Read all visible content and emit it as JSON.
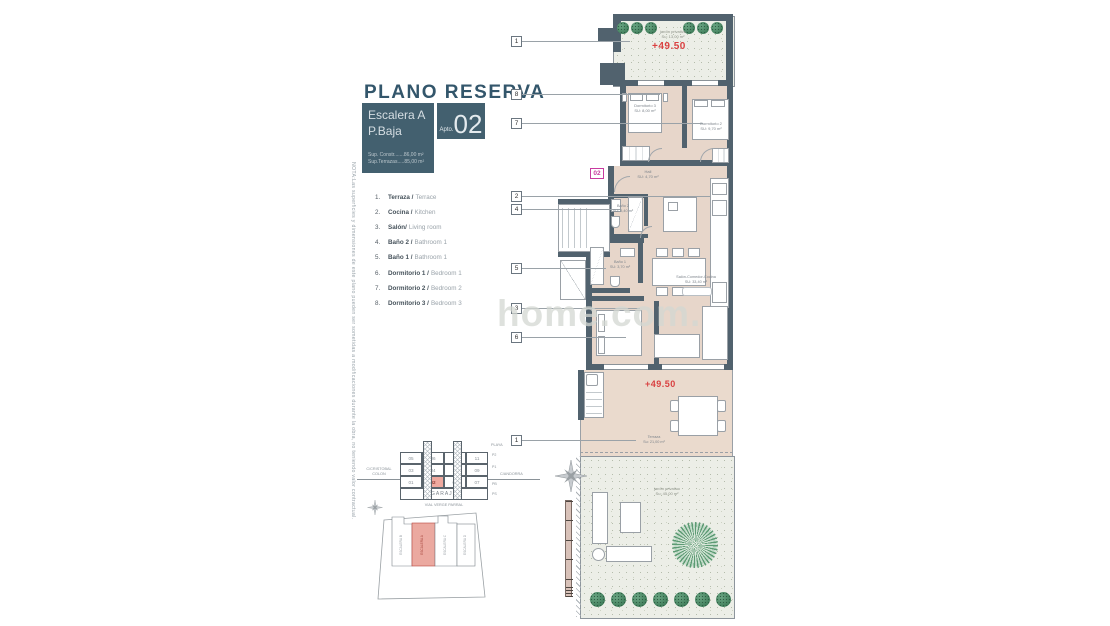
{
  "note": "NOTA:Las superficies y dimensiones de este plano pueden ser sometidas a modificaciones durante la obra, no teniendo valor contractual.",
  "header": {
    "title": "PLANO RESERVA",
    "stair": "Escalera A",
    "floor": "P.Baja",
    "apto_label": "Apto.",
    "apto_number": "02",
    "sup_constr": "Sup. Constr.......86,00 m²",
    "sup_terraza": "Sup.Terrazas.....85,00 m²"
  },
  "legend": {
    "items": [
      {
        "num": "1.",
        "es": "Terraza /",
        "en": "Terrace"
      },
      {
        "num": "2.",
        "es": "Cocina /",
        "en": "Kitchen"
      },
      {
        "num": "3.",
        "es": "Salón/",
        "en": "Living room"
      },
      {
        "num": "4.",
        "es": "Baño 2 /",
        "en": "Bathroom 1"
      },
      {
        "num": "5.",
        "es": "Baño 1 /",
        "en": "Bathroom 1"
      },
      {
        "num": "6.",
        "es": "Dormitorio 1 /",
        "en": "Bedroom 1"
      },
      {
        "num": "7.",
        "es": "Dormitorio 2 /",
        "en": "Bedroom 2"
      },
      {
        "num": "8.",
        "es": "Dormitorio 3 /",
        "en": "Bedroom 3"
      }
    ]
  },
  "markers": [
    "1",
    "8",
    "7",
    "2",
    "4",
    "5",
    "3",
    "6",
    "1"
  ],
  "plan": {
    "unit_badge": "02",
    "level_top": "+49.50",
    "level_terrace": "+49.50",
    "garden_top": {
      "name": "jardín privativo",
      "area": "Su: 13,00 m²"
    },
    "dorm3": {
      "name": "Dormitorio 3",
      "area": "SU: 8,00 m²"
    },
    "dorm2": {
      "name": "Dormitorio 2",
      "area": "SU: 9,70 m²"
    },
    "hall": {
      "name": "Hall",
      "area": "SU: 4,70 m²"
    },
    "bano2": {
      "name": "Baño 2",
      "area": "SU: 3,40 m²"
    },
    "bano1": {
      "name": "Baño 1",
      "area": "SU: 3,70 m²"
    },
    "salon": {
      "name": "Salón-Comedor-Cocina",
      "area": "SU: 33,40 m²"
    },
    "terraza": {
      "name": "Terraza",
      "area": "Su: 21,00 m²"
    },
    "garden_bottom": {
      "name": "jardín privativo",
      "area": "Su: 45,00 m²"
    }
  },
  "watermark": "home.com.",
  "garage": {
    "rows": [
      [
        "05",
        "06",
        "12",
        "11"
      ],
      [
        "03",
        "04",
        "10",
        "09"
      ],
      [
        "01",
        "02",
        "08",
        "07"
      ]
    ],
    "highlight": "02",
    "label": "GARAJE",
    "street_left_1": "C/CRISTOBAL",
    "street_left_2": "COLON",
    "street_right": "C/ANDORRA",
    "playa": "PLAYA",
    "floors": [
      "P2",
      "P1",
      "PB",
      "PS"
    ],
    "caption": "VIAL VERGE PARRAL"
  },
  "siteplan": {
    "units": [
      "ESCALERA B",
      "ESCALERA A",
      "ESCALERA C",
      "ESCALERA D"
    ]
  },
  "colors": {
    "accent_red": "#D94040",
    "accent_magenta": "#C83BA0",
    "header_slate": "#43606F",
    "title_teal": "#33566B",
    "highlight_unit": "#EBA9A0",
    "wall": "#51626E",
    "floor": "#E7D6CA"
  }
}
